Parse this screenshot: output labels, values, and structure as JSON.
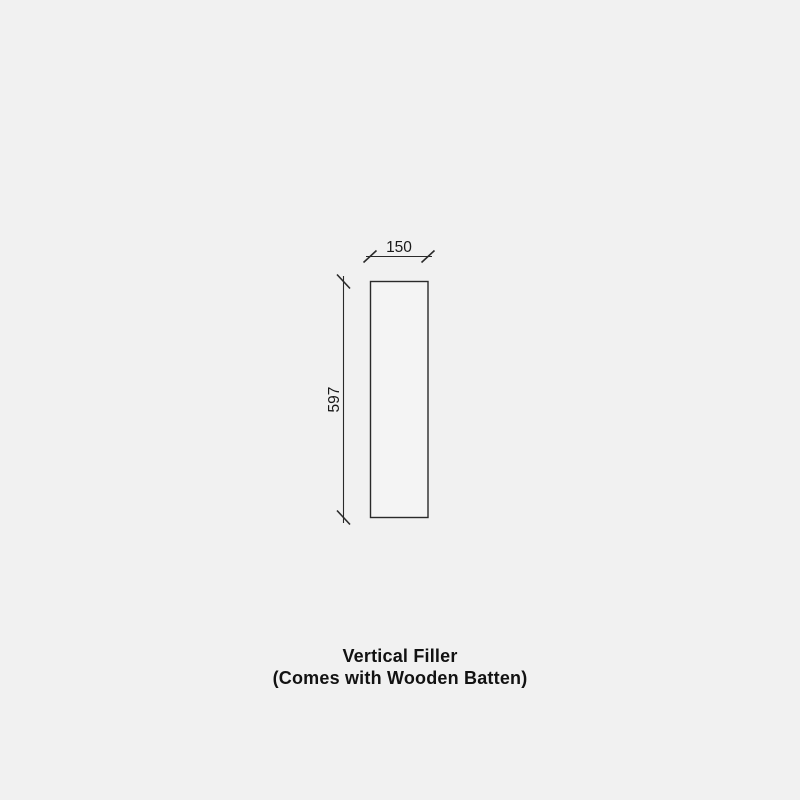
{
  "colors": {
    "background": "#f1f1f1",
    "line": "#2a2a2a",
    "text": "#1a1a1a",
    "panel_fill": "#f4f4f4"
  },
  "diagram": {
    "width_label": "150",
    "height_label": "597"
  },
  "caption": {
    "line1": "Vertical Filler",
    "line2": "(Comes with Wooden Batten)"
  }
}
